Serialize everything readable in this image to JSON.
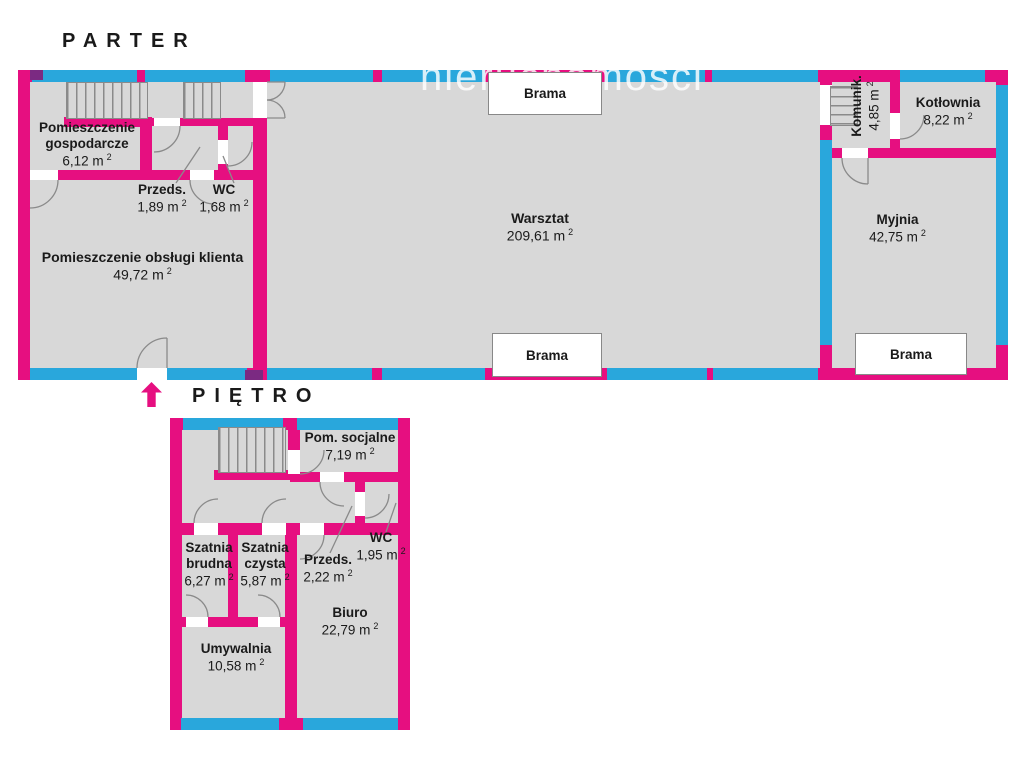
{
  "watermark": "nieruchomości",
  "sup": "2",
  "colors": {
    "wall": "#e60f80",
    "window": "#29a7dc",
    "floor": "#d8d8d8",
    "arrow": "#e60f80"
  },
  "floors": {
    "parter": {
      "title": "PARTER",
      "rooms": [
        {
          "name": "Pomieszczenie gospodarcze",
          "area": "6,12 m"
        },
        {
          "name": "Przeds.",
          "area": "1,89 m"
        },
        {
          "name": "WC",
          "area": "1,68 m"
        },
        {
          "name": "Pomieszczenie obsługi klienta",
          "area": "49,72 m"
        },
        {
          "name": "Warsztat",
          "area": "209,61 m"
        },
        {
          "name": "Komunik.",
          "area": "4,85 m"
        },
        {
          "name": "Kotłownia",
          "area": "8,22 m"
        },
        {
          "name": "Myjnia",
          "area": "42,75 m"
        }
      ],
      "gates": [
        "Brama",
        "Brama",
        "Brama"
      ]
    },
    "pietro": {
      "title": "PIĘTRO",
      "rooms": [
        {
          "name": "Pom. socjalne",
          "area": "7,19 m"
        },
        {
          "name": "Szatnia brudna",
          "area": "6,27 m"
        },
        {
          "name": "Szatnia czysta",
          "area": "5,87 m"
        },
        {
          "name": "Przeds.",
          "area": "2,22 m"
        },
        {
          "name": "WC",
          "area": "1,95 m"
        },
        {
          "name": "Biuro",
          "area": "22,79 m"
        },
        {
          "name": "Umywalnia",
          "area": "10,58 m"
        }
      ]
    }
  }
}
